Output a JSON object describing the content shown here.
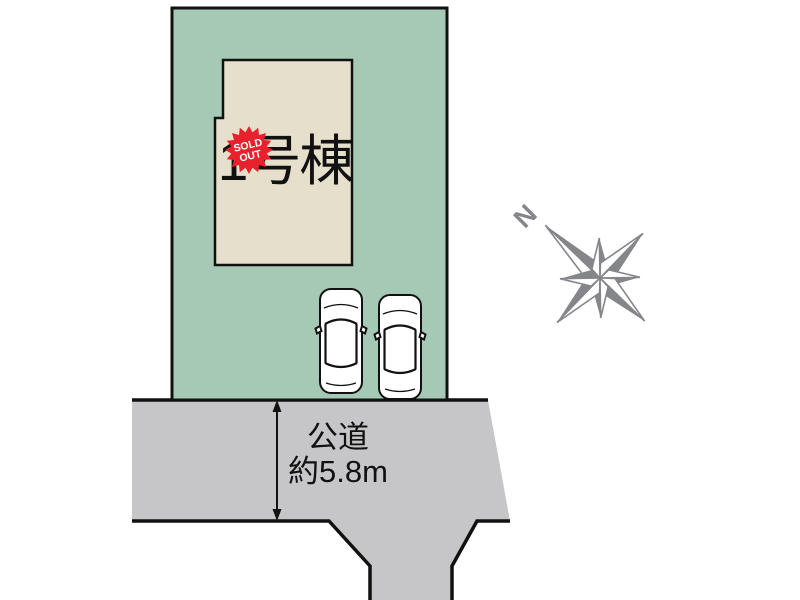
{
  "plot": {
    "building": {
      "label": "1号棟"
    },
    "sold_badge": {
      "line1": "SOLD",
      "line2": "OUT"
    },
    "parked_cars": 2
  },
  "road": {
    "label_line1": "公道",
    "label_line2": "約5.8m"
  },
  "compass": {
    "north_label": "N"
  },
  "colors": {
    "plot_green": "#a6c9b5",
    "building_beige": "#e6dfcc",
    "road_gray": "#c6c6c8",
    "outline": "#111111",
    "badge_red": "#e8212d",
    "badge_text": "#ffffff",
    "compass_gray": "#85868a",
    "text_black": "#111111",
    "car_white": "#ffffff"
  }
}
